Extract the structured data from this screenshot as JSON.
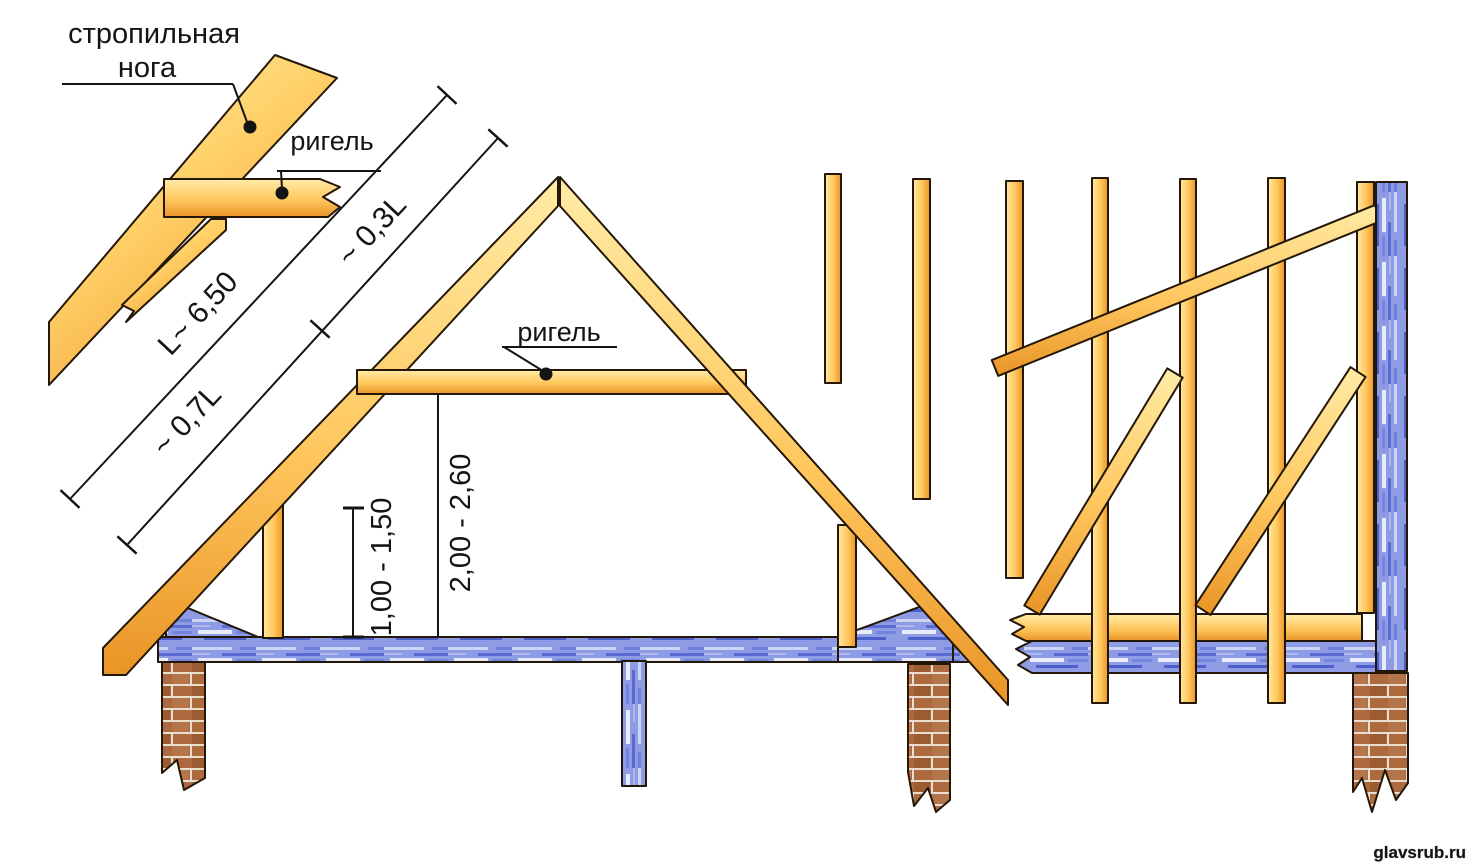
{
  "detail_view": {
    "rafter_label_line1": "стропильная",
    "rafter_label_line2": "нога",
    "collar_label": "ригель"
  },
  "truss": {
    "collar_label": "ригель",
    "dims": {
      "total": "L~ 6,50",
      "lower": "~ 0,7L",
      "upper": "~ 0,3L",
      "knee_wall": "1,00 - 1,50",
      "collar_height": "2,00 - 2,60"
    }
  },
  "watermark": {
    "text": "glavsrub.ru",
    "color": "#8b1717"
  },
  "palette": {
    "background": "#ffffff",
    "outline": "#241708",
    "wood_light": "#fff1ac",
    "wood_mid": "#ffc75e",
    "wood_dark": "#ea9527",
    "blue_wood_light": "#e9edfb",
    "blue_wood_mid": "#8d9ce4",
    "blue_wood_dark": "#4c5ec9",
    "brick": "#ad6a3e",
    "mortar": "#e8ddcf",
    "ink": "#141414"
  }
}
